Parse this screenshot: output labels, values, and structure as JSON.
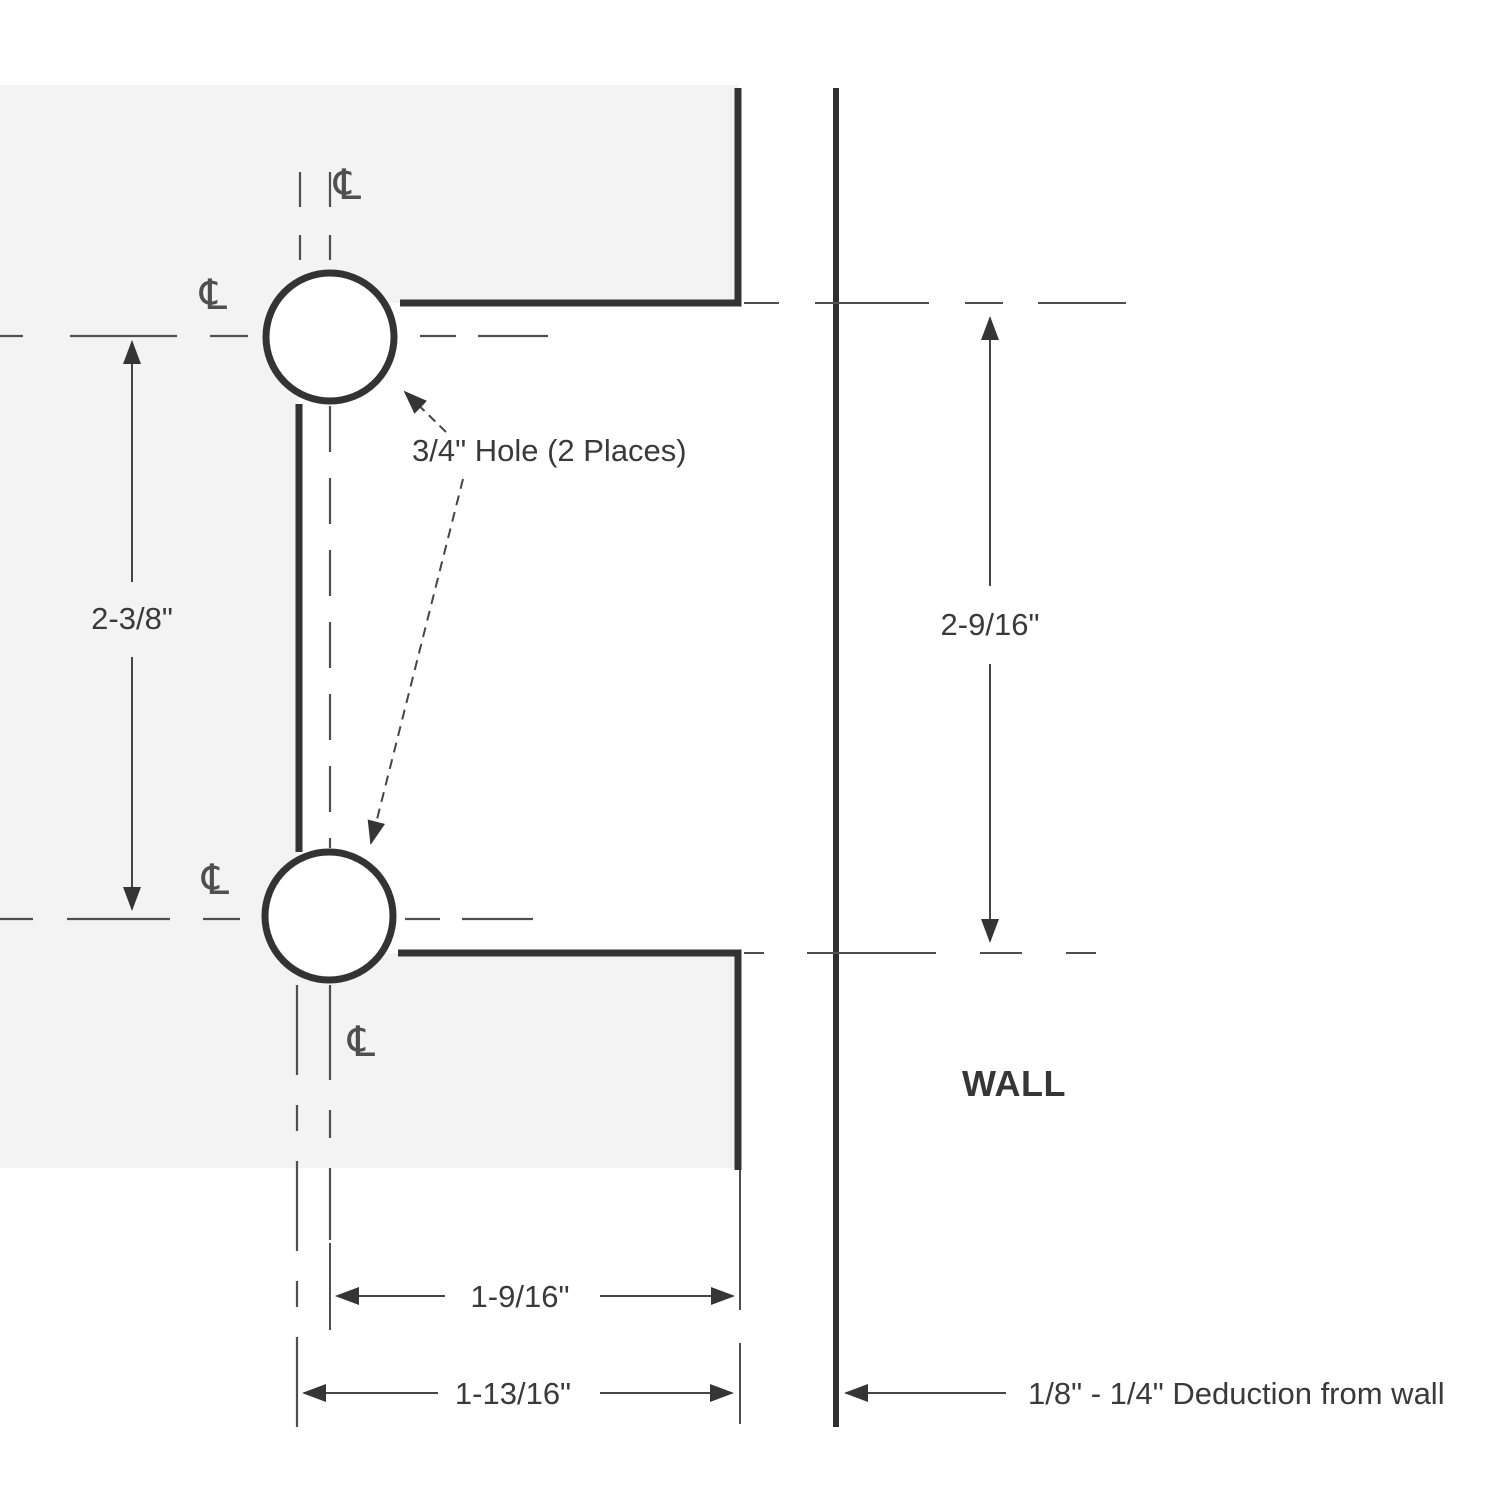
{
  "labels": {
    "hole_note": "3/4\" Hole (2 Places)",
    "wall": "WALL",
    "deduction_note": "1/8\" - 1/4\" Deduction from wall",
    "centerline_symbol": "℄"
  },
  "dimensions": {
    "hole_spacing": "2-3/8\"",
    "cutout_height": "2-9/16\"",
    "hole_center_to_glass_edge": "1-9/16\"",
    "cutout_depth": "1-13/16\""
  },
  "colors": {
    "glass_fill": "#f3f3f4",
    "edge_line": "#333333",
    "wall_line": "#2f2f2f",
    "centerline": "#4f4f4f",
    "dimension_line": "#454545",
    "text": "#3a3a3a"
  }
}
